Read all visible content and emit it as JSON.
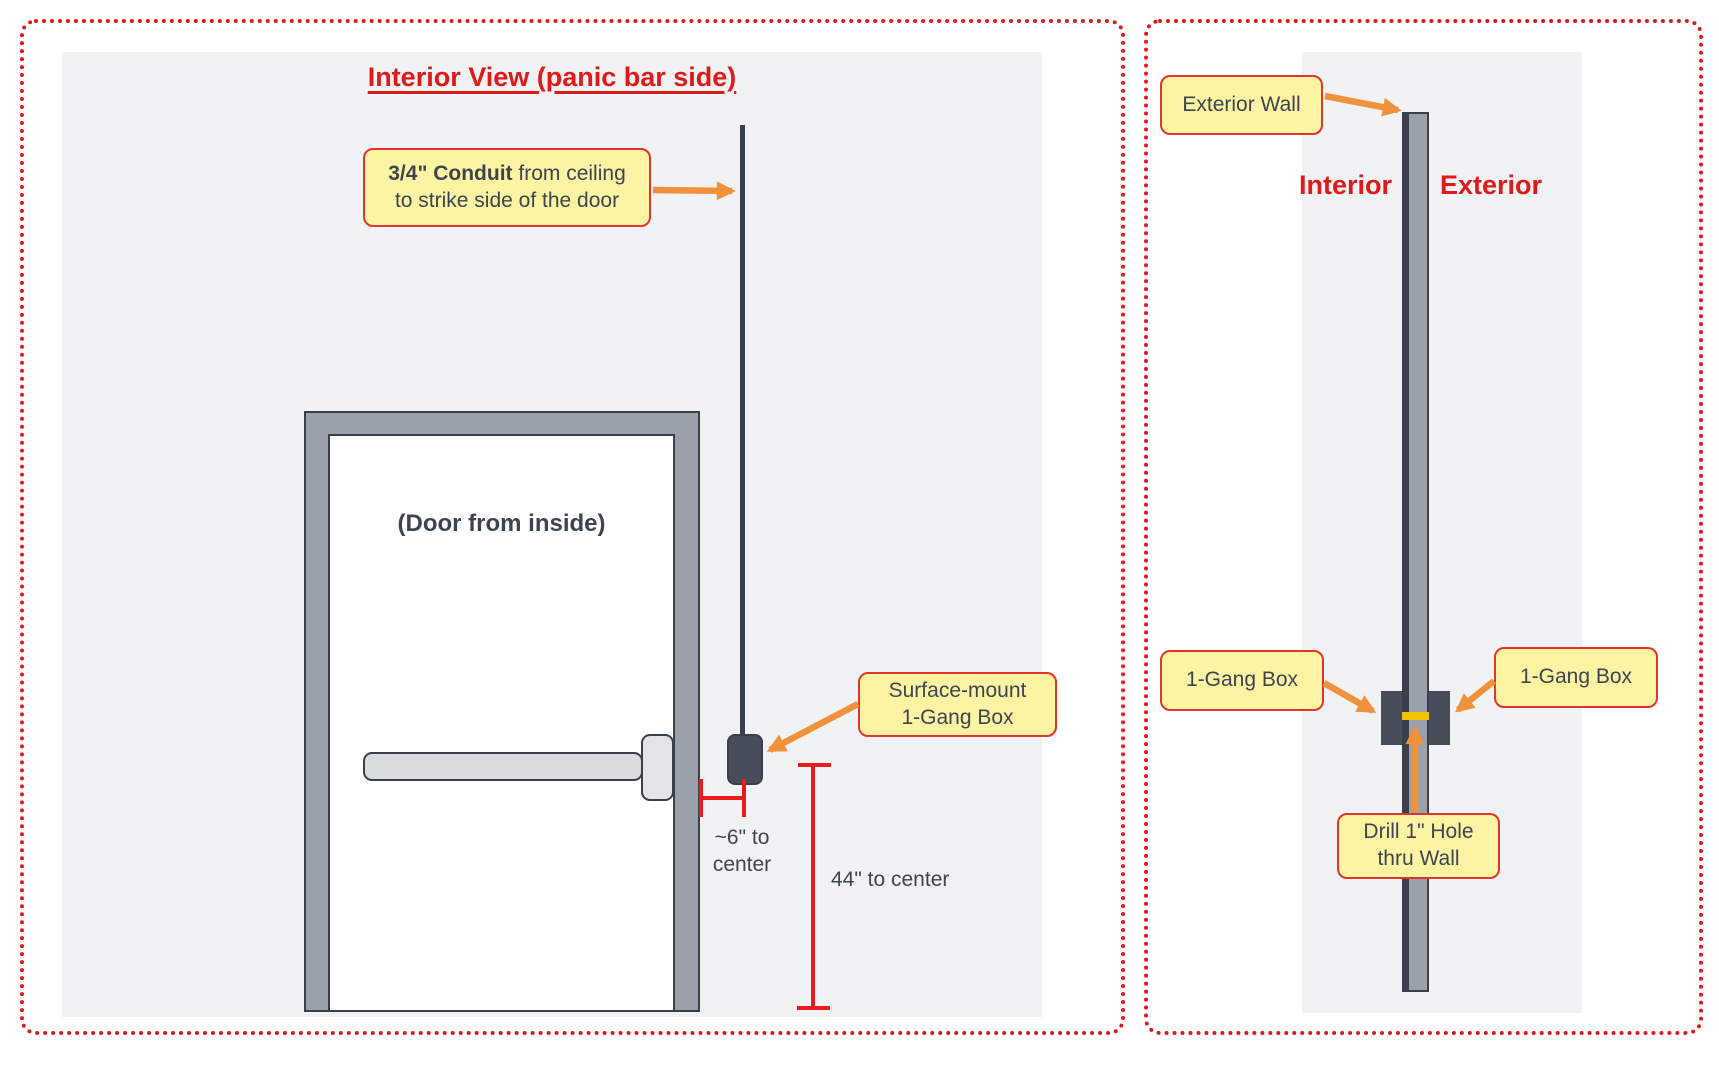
{
  "left_panel": {
    "title": "Interior View (panic bar side)",
    "conduit_callout": {
      "bold": "3/4\" Conduit",
      "line1_rest": " from ceiling",
      "line2": "to strike side of the door"
    },
    "door_label": "(Door from inside)",
    "surface_mount_callout": {
      "line1": "Surface-mount",
      "line2": "1-Gang Box"
    },
    "offset_dim": {
      "line1": "~6\" to",
      "line2": "center"
    },
    "height_dim": "44\" to center"
  },
  "right_panel": {
    "exterior_wall_callout": "Exterior Wall",
    "interior_label": "Interior",
    "exterior_label": "Exterior",
    "interior_gang_box_callout": "1-Gang Box",
    "exterior_gang_box_callout": "1-Gang Box",
    "drill_hole_callout": {
      "line1": "Drill 1\" Hole",
      "line2": "thru Wall"
    }
  },
  "colors": {
    "callout_bg": "#FCF4A3",
    "callout_border": "#E5342B",
    "arrow_orange": "#F0923B",
    "heading_red": "#E01A1A",
    "dimension_red": "#EC1C1C",
    "panel_bg": "#F1F2F4",
    "frame_gray": "#9AA1AB",
    "dark_slate": "#474E5A",
    "outline_dark": "#39404C",
    "hole_yellow": "#F2C100",
    "text_dark": "#3E4552"
  }
}
